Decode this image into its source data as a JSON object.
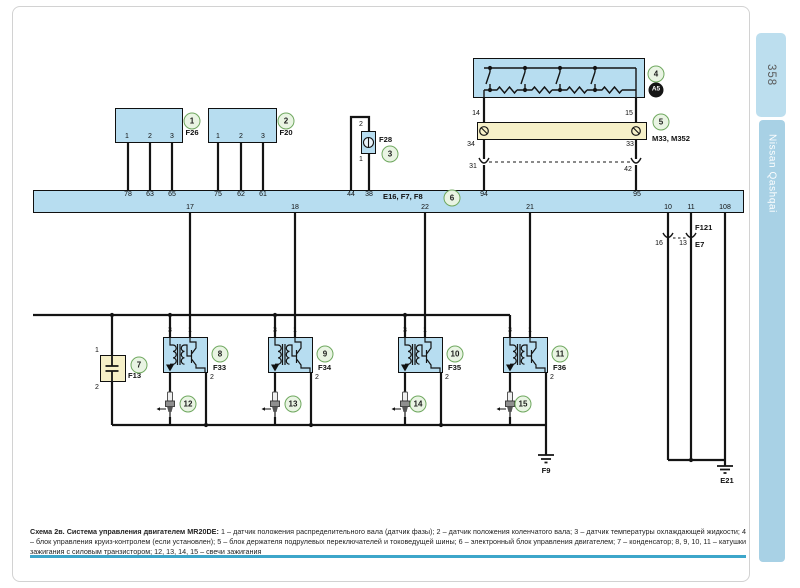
{
  "sidebar": {
    "page_number": "358",
    "brand": "Nissan Qashqai"
  },
  "caption": {
    "title": "Схема 2в. Система управления двигателем MR20DE:",
    "body": "1 – датчик положения распределительного вала (датчик фазы); 2 – датчик положения коленчатого вала; 3 – датчик температуры охлаждающей жидкости; 4 – блок управления круиз-контролем (если установлен); 5 – блок держателя подрулевых переключателей и токоведущей шины; 6 – электронный блок управления двигателем; 7 – конденсатор; 8, 9, 10, 11 – катушки зажигания с силовым транзистором; 12, 13, 14, 15 – свечи зажигания"
  },
  "colors": {
    "block_blue": "#b7ddf0",
    "block_yellow": "#f6f0c8",
    "wire": "#141414",
    "ref_green_border": "#6fa85f",
    "ref_green_fill": "#e9f4e3",
    "sidebar_tab": "#bcdeee",
    "sidebar_bar": "#a8d1e5",
    "separator": "#3da6ca"
  },
  "labels": [
    {
      "n": "ecu-pin-78",
      "t": "78",
      "x": 128,
      "y": 191,
      "c": "pin"
    },
    {
      "n": "ecu-pin-63",
      "t": "63",
      "x": 150,
      "y": 191,
      "c": "pin"
    },
    {
      "n": "ecu-pin-65",
      "t": "65",
      "x": 172,
      "y": 191,
      "c": "pin"
    },
    {
      "n": "ecu-pin-75",
      "t": "75",
      "x": 218,
      "y": 191,
      "c": "pin"
    },
    {
      "n": "ecu-pin-62",
      "t": "62",
      "x": 241,
      "y": 191,
      "c": "pin"
    },
    {
      "n": "ecu-pin-61",
      "t": "61",
      "x": 263,
      "y": 191,
      "c": "pin"
    },
    {
      "n": "ecu-pin-44",
      "t": "44",
      "x": 351,
      "y": 191,
      "c": "pin"
    },
    {
      "n": "ecu-pin-38",
      "t": "38",
      "x": 369,
      "y": 191,
      "c": "pin"
    },
    {
      "n": "ecu-pin-94",
      "t": "94",
      "x": 484,
      "y": 191,
      "c": "pin"
    },
    {
      "n": "ecu-pin-95",
      "t": "95",
      "x": 637,
      "y": 191,
      "c": "pin"
    },
    {
      "n": "ecu-pin-17",
      "t": "17",
      "x": 190,
      "y": 204,
      "c": "pin"
    },
    {
      "n": "ecu-pin-18",
      "t": "18",
      "x": 295,
      "y": 204,
      "c": "pin"
    },
    {
      "n": "ecu-pin-22",
      "t": "22",
      "x": 425,
      "y": 204,
      "c": "pin"
    },
    {
      "n": "ecu-pin-21",
      "t": "21",
      "x": 530,
      "y": 204,
      "c": "pin"
    },
    {
      "n": "ecu-pin-10",
      "t": "10",
      "x": 668,
      "y": 204,
      "c": "pin"
    },
    {
      "n": "ecu-pin-11",
      "t": "11",
      "x": 691,
      "y": 204,
      "c": "pin"
    },
    {
      "n": "ecu-pin-108",
      "t": "108",
      "x": 725,
      "y": 204,
      "c": "pin"
    },
    {
      "n": "f26-pin-1",
      "t": "1",
      "x": 127,
      "y": 133,
      "c": "pin"
    },
    {
      "n": "f26-pin-2",
      "t": "2",
      "x": 150,
      "y": 133,
      "c": "pin"
    },
    {
      "n": "f26-pin-3",
      "t": "3",
      "x": 172,
      "y": 133,
      "c": "pin"
    },
    {
      "n": "f20-pin-1",
      "t": "1",
      "x": 218,
      "y": 133,
      "c": "pin"
    },
    {
      "n": "f20-pin-2",
      "t": "2",
      "x": 241,
      "y": 133,
      "c": "pin"
    },
    {
      "n": "f20-pin-3",
      "t": "3",
      "x": 263,
      "y": 133,
      "c": "pin"
    },
    {
      "n": "f28-pin-2",
      "t": "2",
      "x": 361,
      "y": 121,
      "c": "pin"
    },
    {
      "n": "f28-pin-1",
      "t": "1",
      "x": 361,
      "y": 156,
      "c": "pin"
    },
    {
      "n": "m33-pin-14",
      "t": "14",
      "x": 476,
      "y": 110,
      "c": "pin"
    },
    {
      "n": "m33-pin-15",
      "t": "15",
      "x": 629,
      "y": 110,
      "c": "pin"
    },
    {
      "n": "m33-pin-34",
      "t": "34",
      "x": 471,
      "y": 141,
      "c": "pin"
    },
    {
      "n": "m33-pin-33",
      "t": "33",
      "x": 630,
      "y": 141,
      "c": "pin"
    },
    {
      "n": "inline-pin-31",
      "t": "31",
      "x": 473,
      "y": 163,
      "c": "pin"
    },
    {
      "n": "inline-pin-42",
      "t": "42",
      "x": 628,
      "y": 166,
      "c": "pin"
    },
    {
      "n": "e7-pin-16",
      "t": "16",
      "x": 659,
      "y": 240,
      "c": "pin"
    },
    {
      "n": "e7-pin-13",
      "t": "13",
      "x": 683,
      "y": 240,
      "c": "pin"
    },
    {
      "n": "f33-pin-3",
      "t": "3",
      "x": 170,
      "y": 327,
      "c": "pin"
    },
    {
      "n": "f33-pin-1",
      "t": "1",
      "x": 190,
      "y": 327,
      "c": "pin"
    },
    {
      "n": "f33-pin-2",
      "t": "2",
      "x": 212,
      "y": 374,
      "c": "pin"
    },
    {
      "n": "f34-pin-3",
      "t": "3",
      "x": 275,
      "y": 327,
      "c": "pin"
    },
    {
      "n": "f34-pin-1",
      "t": "1",
      "x": 295,
      "y": 327,
      "c": "pin"
    },
    {
      "n": "f34-pin-2",
      "t": "2",
      "x": 317,
      "y": 374,
      "c": "pin"
    },
    {
      "n": "f35-pin-3",
      "t": "3",
      "x": 405,
      "y": 327,
      "c": "pin"
    },
    {
      "n": "f35-pin-1",
      "t": "1",
      "x": 425,
      "y": 327,
      "c": "pin"
    },
    {
      "n": "f35-pin-2",
      "t": "2",
      "x": 447,
      "y": 374,
      "c": "pin"
    },
    {
      "n": "f36-pin-3",
      "t": "3",
      "x": 510,
      "y": 327,
      "c": "pin"
    },
    {
      "n": "f36-pin-1",
      "t": "1",
      "x": 530,
      "y": 327,
      "c": "pin"
    },
    {
      "n": "f36-pin-2",
      "t": "2",
      "x": 552,
      "y": 374,
      "c": "pin"
    },
    {
      "n": "f13-pin-1",
      "t": "1",
      "x": 97,
      "y": 347,
      "c": "pin"
    },
    {
      "n": "f13-pin-2",
      "t": "2",
      "x": 97,
      "y": 384,
      "c": "pin"
    },
    {
      "n": "f26-label",
      "t": "F26",
      "x": 192,
      "y": 129,
      "c": "compc"
    },
    {
      "n": "f20-label",
      "t": "F20",
      "x": 286,
      "y": 129,
      "c": "compc"
    },
    {
      "n": "f28-label",
      "t": "F28",
      "x": 379,
      "y": 136,
      "c": "comp"
    },
    {
      "n": "m33-label",
      "t": "M33, M352",
      "x": 652,
      "y": 135,
      "c": "comp"
    },
    {
      "n": "ecu-label",
      "t": "E16, F7, F8",
      "x": 383,
      "y": 193,
      "c": "comp"
    },
    {
      "n": "f121-label",
      "t": "F121",
      "x": 695,
      "y": 224,
      "c": "comp"
    },
    {
      "n": "e7-label",
      "t": "E7",
      "x": 695,
      "y": 241,
      "c": "comp"
    },
    {
      "n": "f13-label",
      "t": "F13",
      "x": 128,
      "y": 372,
      "c": "comp"
    },
    {
      "n": "f33-label",
      "t": "F33",
      "x": 213,
      "y": 364,
      "c": "comp"
    },
    {
      "n": "f34-label",
      "t": "F34",
      "x": 318,
      "y": 364,
      "c": "comp"
    },
    {
      "n": "f35-label",
      "t": "F35",
      "x": 448,
      "y": 364,
      "c": "comp"
    },
    {
      "n": "f36-label",
      "t": "F36",
      "x": 553,
      "y": 364,
      "c": "comp"
    },
    {
      "n": "f9-label",
      "t": "F9",
      "x": 546,
      "y": 467,
      "c": "compc"
    },
    {
      "n": "e21-label",
      "t": "E21",
      "x": 727,
      "y": 477,
      "c": "compc"
    }
  ],
  "refs": [
    {
      "n": "ref-1",
      "t": "1",
      "x": 192,
      "y": 121
    },
    {
      "n": "ref-2",
      "t": "2",
      "x": 286,
      "y": 121
    },
    {
      "n": "ref-3",
      "t": "3",
      "x": 390,
      "y": 154
    },
    {
      "n": "ref-4",
      "t": "4",
      "x": 656,
      "y": 74
    },
    {
      "n": "ref-a5",
      "t": "A5",
      "x": 656,
      "y": 90,
      "c": "dark"
    },
    {
      "n": "ref-5",
      "t": "5",
      "x": 661,
      "y": 122
    },
    {
      "n": "ref-6",
      "t": "6",
      "x": 452,
      "y": 198
    },
    {
      "n": "ref-7",
      "t": "7",
      "x": 139,
      "y": 365
    },
    {
      "n": "ref-8",
      "t": "8",
      "x": 220,
      "y": 354
    },
    {
      "n": "ref-9",
      "t": "9",
      "x": 325,
      "y": 354
    },
    {
      "n": "ref-10",
      "t": "10",
      "x": 455,
      "y": 354
    },
    {
      "n": "ref-11",
      "t": "11",
      "x": 560,
      "y": 354
    },
    {
      "n": "ref-12",
      "t": "12",
      "x": 188,
      "y": 404
    },
    {
      "n": "ref-13",
      "t": "13",
      "x": 293,
      "y": 404
    },
    {
      "n": "ref-14",
      "t": "14",
      "x": 418,
      "y": 404
    },
    {
      "n": "ref-15",
      "t": "15",
      "x": 523,
      "y": 404
    }
  ]
}
